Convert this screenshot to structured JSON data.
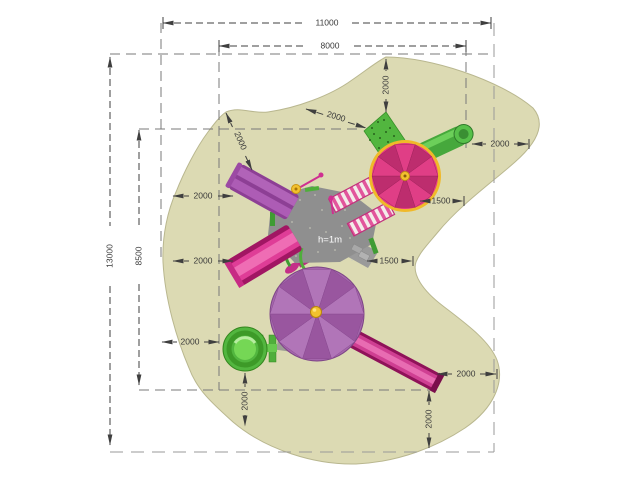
{
  "plan": {
    "platform_label": "h=1m",
    "dims": {
      "top_outer": "11000",
      "top_inner": "8000",
      "left_outer": "13000",
      "left_inner": "8500",
      "diag_left": "2000",
      "diag_right": "2000",
      "top_vertical": "2000",
      "right_top": "2000",
      "right_upper_1500": "1500",
      "right_lower_1500": "1500",
      "left_upper": "2000",
      "left_middle": "2000",
      "left_lower": "2000",
      "bottom_left_vertical": "2000",
      "bottom_right_horizontal": "2000",
      "bottom_right_vertical": "2000"
    },
    "colors": {
      "surface": "#dcdab3",
      "surface_edge": "#b9b78f",
      "dimension_lines": "#3f3f3f",
      "carousel_canopy": "#e23a85",
      "carousel_rim": "#f0b929",
      "umbrella_canopy": "#a466ac",
      "slide_magenta": "#cf3f92",
      "slide_violet": "#b163b8",
      "equipment_green": "#52b63f",
      "platform_gray": "#8f8f8f",
      "hub_yellow": "#f2c12e"
    }
  }
}
